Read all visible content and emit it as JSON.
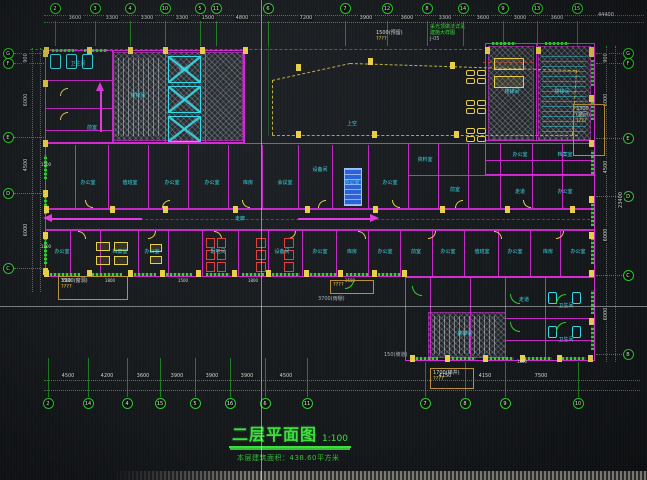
{
  "colors": {
    "background": "#171a1d",
    "grid_green": "#2ecc2e",
    "wall_magenta": "#d42ad4",
    "label_cyan": "#38d8e6",
    "fitting_yellow": "#e8cf4a",
    "alert_red": "#e04040",
    "equipment_blue": "#2b62d8",
    "dim_text": "#d8dde0",
    "title_green": "#3be03b"
  },
  "title_block": {
    "title": "二层平面图",
    "scale": "1:100",
    "subtitle": "本层建筑面积：438.60平方米"
  },
  "grid": {
    "top": {
      "bubbles": [
        {
          "x": 55,
          "t": "2"
        },
        {
          "x": 95,
          "t": "3"
        },
        {
          "x": 130,
          "t": "4"
        },
        {
          "x": 165,
          "t": "10"
        },
        {
          "x": 200,
          "t": "5"
        },
        {
          "x": 216,
          "t": "11"
        },
        {
          "x": 268,
          "t": "6"
        },
        {
          "x": 345,
          "t": "7"
        },
        {
          "x": 387,
          "t": "12"
        },
        {
          "x": 427,
          "t": "8"
        },
        {
          "x": 463,
          "t": "14"
        },
        {
          "x": 503,
          "t": "9"
        },
        {
          "x": 537,
          "t": "13"
        },
        {
          "x": 577,
          "t": "15"
        }
      ],
      "dims": [
        {
          "x": 75,
          "t": "3600"
        },
        {
          "x": 112,
          "t": "3300"
        },
        {
          "x": 147,
          "t": "3300"
        },
        {
          "x": 182,
          "t": "3300"
        },
        {
          "x": 208,
          "t": "1500"
        },
        {
          "x": 242,
          "t": "4800"
        },
        {
          "x": 306,
          "t": "7200"
        },
        {
          "x": 366,
          "t": "3900"
        },
        {
          "x": 407,
          "t": "3600"
        },
        {
          "x": 445,
          "t": "3300"
        },
        {
          "x": 483,
          "t": "3600"
        },
        {
          "x": 520,
          "t": "3000"
        },
        {
          "x": 557,
          "t": "3600"
        }
      ]
    },
    "bottom": {
      "bubbles": [
        {
          "x": 48,
          "t": "2"
        },
        {
          "x": 88,
          "t": "14"
        },
        {
          "x": 127,
          "t": "4"
        },
        {
          "x": 160,
          "t": "15"
        },
        {
          "x": 195,
          "t": "5"
        },
        {
          "x": 230,
          "t": "16"
        },
        {
          "x": 265,
          "t": "6"
        },
        {
          "x": 307,
          "t": "11"
        }
      ],
      "dims": [
        {
          "x": 68,
          "t": "4500"
        },
        {
          "x": 107,
          "t": "4200"
        },
        {
          "x": 143,
          "t": "3600"
        },
        {
          "x": 177,
          "t": "3900"
        },
        {
          "x": 212,
          "t": "3900"
        },
        {
          "x": 247,
          "t": "3900"
        },
        {
          "x": 286,
          "t": "4500"
        }
      ]
    },
    "bottom_right": {
      "bubbles": [
        {
          "x": 425,
          "t": "7"
        },
        {
          "x": 465,
          "t": "8"
        },
        {
          "x": 505,
          "t": "9"
        },
        {
          "x": 578,
          "t": "10"
        }
      ],
      "dims": [
        {
          "x": 445,
          "t": "4150"
        },
        {
          "x": 485,
          "t": "4150"
        },
        {
          "x": 541,
          "t": "7500"
        }
      ]
    },
    "left": {
      "bubbles": [
        {
          "y": 53,
          "t": "G"
        },
        {
          "y": 63,
          "t": "F"
        },
        {
          "y": 137,
          "t": "E"
        },
        {
          "y": 193,
          "t": "D"
        },
        {
          "y": 268,
          "t": "C"
        }
      ],
      "dims": [
        {
          "y": 58,
          "t": "900"
        },
        {
          "y": 100,
          "t": "6000"
        },
        {
          "y": 165,
          "t": "4500"
        },
        {
          "y": 230,
          "t": "6000"
        }
      ]
    },
    "right": {
      "bubbles": [
        {
          "y": 53,
          "t": "G"
        },
        {
          "y": 63,
          "t": "F"
        },
        {
          "y": 138,
          "t": "E"
        },
        {
          "y": 196,
          "t": "D"
        },
        {
          "y": 275,
          "t": "C"
        },
        {
          "y": 354,
          "t": "B"
        }
      ],
      "dims": [
        {
          "y": 58,
          "t": "900"
        },
        {
          "y": 100,
          "t": "6000"
        },
        {
          "y": 167,
          "t": "4500"
        },
        {
          "y": 235,
          "t": "6000"
        },
        {
          "y": 314,
          "t": "6000"
        }
      ],
      "overall": "23400"
    },
    "overall_top_right": "44400"
  },
  "rooms": [
    {
      "x": 88,
      "y": 183,
      "t": "办公室"
    },
    {
      "x": 130,
      "y": 183,
      "t": "值班室"
    },
    {
      "x": 172,
      "y": 183,
      "t": "办公室"
    },
    {
      "x": 212,
      "y": 183,
      "t": "办公室"
    },
    {
      "x": 248,
      "y": 183,
      "t": "库房"
    },
    {
      "x": 285,
      "y": 183,
      "t": "会议室"
    },
    {
      "x": 320,
      "y": 170,
      "t": "设备间"
    },
    {
      "x": 352,
      "y": 183,
      "t": "办公室"
    },
    {
      "x": 390,
      "y": 183,
      "t": "办公室"
    },
    {
      "x": 425,
      "y": 160,
      "t": "资料室"
    },
    {
      "x": 455,
      "y": 190,
      "t": "前室"
    },
    {
      "x": 520,
      "y": 155,
      "t": "办公室"
    },
    {
      "x": 565,
      "y": 155,
      "t": "档案室"
    },
    {
      "x": 520,
      "y": 192,
      "t": "走道"
    },
    {
      "x": 565,
      "y": 192,
      "t": "办公室"
    },
    {
      "x": 62,
      "y": 252,
      "t": "办公室"
    },
    {
      "x": 120,
      "y": 252,
      "t": "档案室"
    },
    {
      "x": 152,
      "y": 252,
      "t": "办公室"
    },
    {
      "x": 218,
      "y": 252,
      "t": "配电间"
    },
    {
      "x": 282,
      "y": 252,
      "t": "设备间"
    },
    {
      "x": 320,
      "y": 252,
      "t": "办公室"
    },
    {
      "x": 352,
      "y": 252,
      "t": "库房"
    },
    {
      "x": 385,
      "y": 252,
      "t": "办公室"
    },
    {
      "x": 416,
      "y": 252,
      "t": "前室"
    },
    {
      "x": 448,
      "y": 252,
      "t": "办公室"
    },
    {
      "x": 482,
      "y": 252,
      "t": "值班室"
    },
    {
      "x": 515,
      "y": 252,
      "t": "办公室"
    },
    {
      "x": 548,
      "y": 252,
      "t": "库房"
    },
    {
      "x": 578,
      "y": 252,
      "t": "办公室"
    },
    {
      "x": 240,
      "y": 219,
      "t": "走廊"
    },
    {
      "x": 352,
      "y": 124,
      "t": "上空"
    },
    {
      "x": 465,
      "y": 334,
      "t": "楼梯间"
    },
    {
      "x": 524,
      "y": 300,
      "t": "走道"
    },
    {
      "x": 566,
      "y": 306,
      "t": "卫生间"
    },
    {
      "x": 566,
      "y": 340,
      "t": "卫生间"
    },
    {
      "x": 78,
      "y": 64,
      "t": "卫生间"
    },
    {
      "x": 138,
      "y": 96,
      "t": "楼梯间"
    },
    {
      "x": 184,
      "y": 70,
      "t": "电梯"
    },
    {
      "x": 92,
      "y": 128,
      "t": "前室"
    },
    {
      "x": 512,
      "y": 92,
      "t": "楼梯间"
    },
    {
      "x": 562,
      "y": 92,
      "t": "楼梯间"
    }
  ],
  "annotations": [
    {
      "x": 58,
      "y": 276,
      "w": 70,
      "h": 24,
      "box": true,
      "lines": [
        {
          "t": "3300(窗洞)",
          "c": "white"
        },
        {
          "t": "????",
          "c": "yellow"
        }
      ]
    },
    {
      "x": 330,
      "y": 280,
      "w": 44,
      "h": 14,
      "box": true,
      "lines": [
        {
          "t": "????",
          "c": "yellow"
        }
      ]
    },
    {
      "x": 318,
      "y": 296,
      "lines": [
        {
          "t": "3700(雨棚)",
          "c": "grey"
        }
      ]
    },
    {
      "x": 430,
      "y": 368,
      "w": 44,
      "h": 21,
      "box": true,
      "lines": [
        {
          "t": "1700(梯井)",
          "c": "white"
        },
        {
          "t": "????",
          "c": "yellow"
        }
      ]
    },
    {
      "x": 573,
      "y": 104,
      "w": 32,
      "h": 52,
      "box": true,
      "lines": [
        {
          "t": "3300",
          "c": "white"
        },
        {
          "t": "(窗间)",
          "c": "white"
        },
        {
          "t": "????",
          "c": "yellow"
        }
      ]
    },
    {
      "x": 376,
      "y": 30,
      "lines": [
        {
          "t": "1500(预留)",
          "c": "white"
        },
        {
          "t": "????",
          "c": "yellow"
        }
      ]
    },
    {
      "x": 430,
      "y": 24,
      "lines": [
        {
          "t": "采光顶做法详见",
          "c": "green"
        },
        {
          "t": "建施大样图",
          "c": "green"
        },
        {
          "t": "J-05",
          "c": "grey"
        }
      ]
    },
    {
      "x": 384,
      "y": 352,
      "lines": [
        {
          "t": "150(坡道)",
          "c": "grey"
        }
      ]
    },
    {
      "x": 598,
      "y": 12,
      "lines": [
        {
          "t": "44400",
          "c": "white"
        }
      ]
    }
  ],
  "wall_texts": [
    {
      "x": 66,
      "y": 281,
      "t": "1500"
    },
    {
      "x": 110,
      "y": 281,
      "t": "1800"
    },
    {
      "x": 183,
      "y": 281,
      "t": "1500"
    },
    {
      "x": 253,
      "y": 281,
      "t": "1800"
    },
    {
      "x": 350,
      "y": 281,
      "t": "1500"
    },
    {
      "x": 522,
      "y": 362,
      "t": "1800"
    },
    {
      "x": 46,
      "y": 165,
      "t": "1500"
    },
    {
      "x": 46,
      "y": 247,
      "t": "1500"
    }
  ]
}
